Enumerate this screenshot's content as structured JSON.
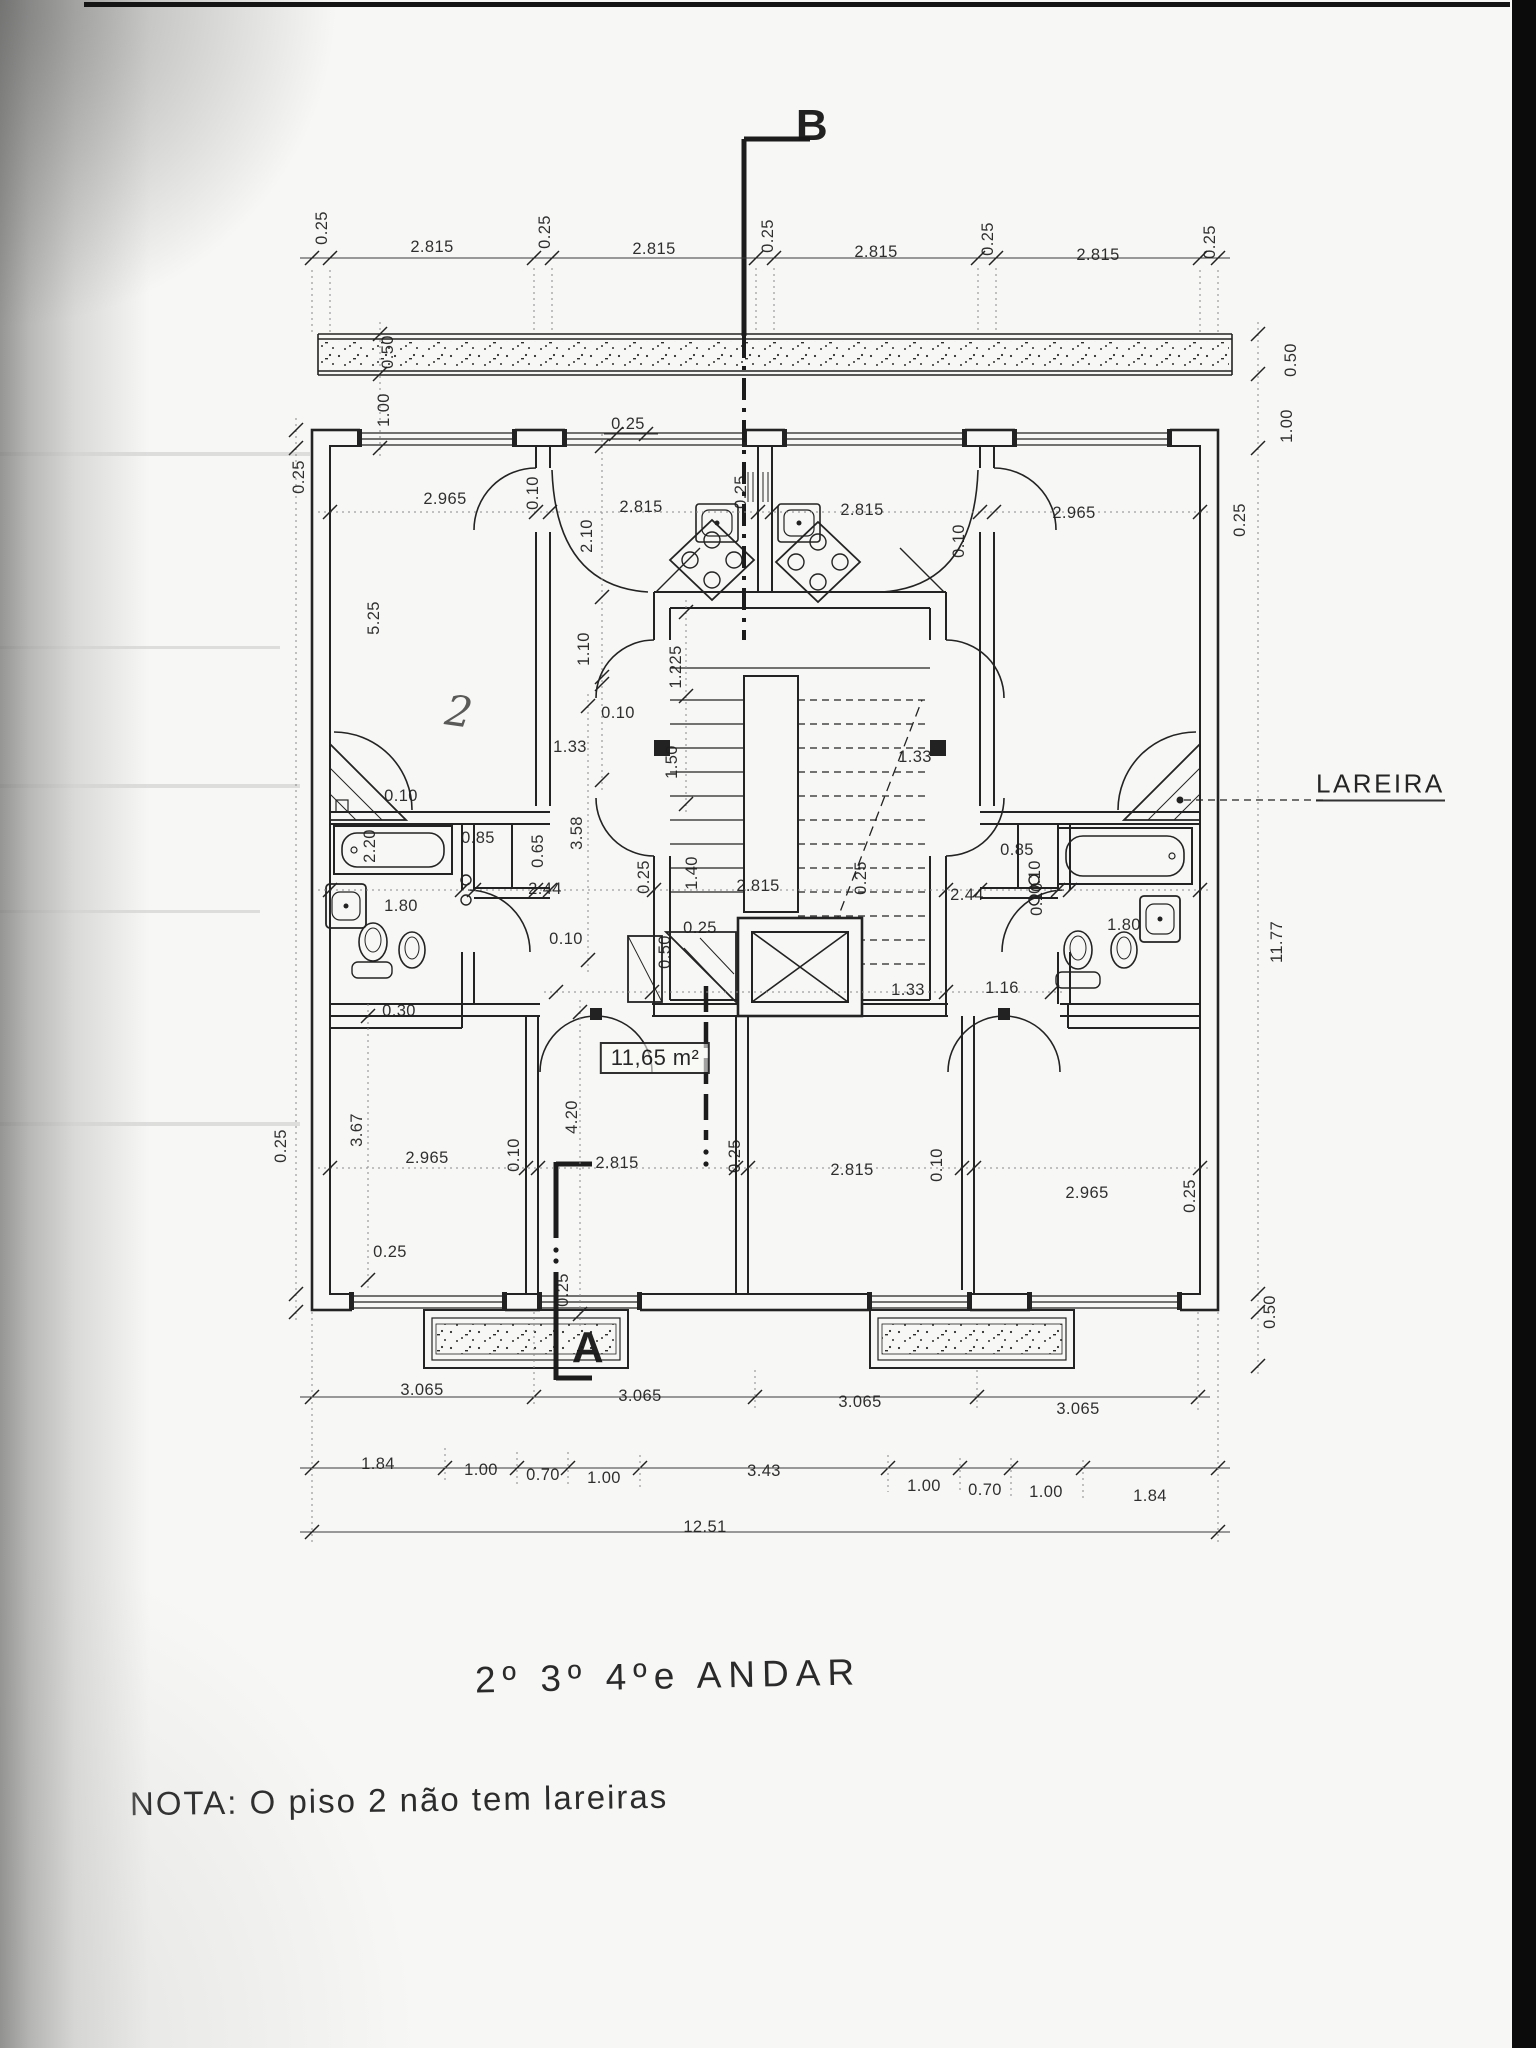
{
  "drawing": {
    "title": "2º 3º 4ºe ANDAR",
    "note": "NOTA: O piso 2 não tem lareiras",
    "section_marks": {
      "b": "B",
      "a": "A"
    },
    "fireplace_label": "LAREIRA",
    "area_label": "11,65 m²",
    "room_mark": "2",
    "dims": {
      "top": [
        "0.25",
        "2.815",
        "0.25",
        "2.815",
        "0.25",
        "2.815",
        "0.25",
        "2.815",
        "0.25"
      ],
      "upper_rooms": [
        "2.965",
        "0.10",
        "0.25",
        "2.815",
        "0.25",
        "2.815",
        "0.10",
        "2.965"
      ],
      "margin_left": [
        "0.50",
        "1.00",
        "0.25",
        "5.25",
        "0.25"
      ],
      "margin_right": [
        "0.50",
        "1.00",
        "0.25",
        "11.77",
        "0.50",
        "0.25"
      ],
      "interior_upper": [
        "2.10",
        "1.10",
        "0.10",
        "1.33",
        "1.225",
        "1.50",
        "3.58",
        "1.33"
      ],
      "bath_left": [
        "0.10",
        "2.20",
        "0.85",
        "0.65",
        "2.44",
        "1.80",
        "0.10",
        "0.30"
      ],
      "hall": [
        "0.25",
        "1.40",
        "2.815",
        "0.25",
        "0.25",
        "0.50",
        "1.33",
        "1.16"
      ],
      "bath_right": [
        "0.85",
        "0.10",
        "0.10",
        "2.44",
        "1.80"
      ],
      "bottom_rooms": [
        "3.67",
        "2.965",
        "0.10",
        "4.20",
        "2.815",
        "0.25",
        "2.815",
        "0.10",
        "2.965",
        "0.25",
        "0.25"
      ],
      "chain_3065": [
        "3.065",
        "3.065",
        "3.065",
        "3.065"
      ],
      "chain_detail": [
        "1.84",
        "1.00",
        "0.70",
        "1.00",
        "3.43",
        "1.00",
        "0.70",
        "1.00",
        "1.84"
      ],
      "total": "12.51"
    }
  }
}
